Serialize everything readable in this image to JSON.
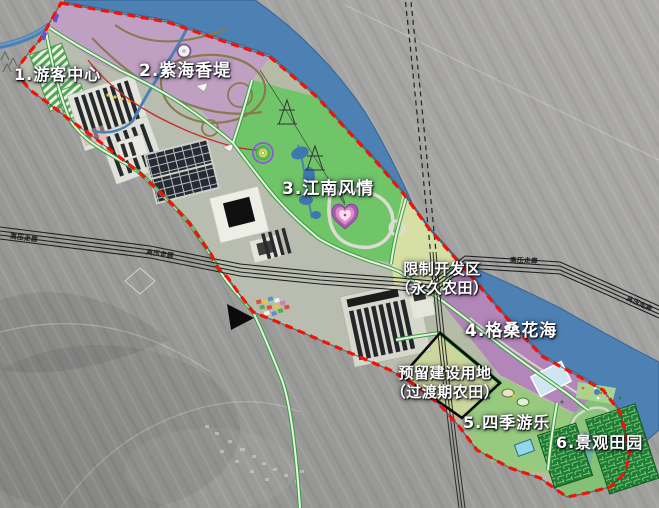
{
  "map": {
    "zones": [
      {
        "label": "1.游客中心"
      },
      {
        "label": "2.紫海香堤"
      },
      {
        "label": "3.江南风情"
      },
      {
        "label": "4.格桑花海"
      },
      {
        "label": "5.四季游乐"
      },
      {
        "label": "6.景观田园"
      }
    ],
    "restricted_area": {
      "line1": "限制开发区",
      "line2": "（永久农田）"
    },
    "reserved_area": {
      "line1": "预留建设用地",
      "line2": "（过渡期农田）"
    },
    "power_corridor_label": "高压走廊",
    "colors": {
      "boundary_red": "#ef1408",
      "river_blue": "#4d81b4",
      "zone1_gray": "#b9bdb0",
      "zone2_purple": "#c0a0c2",
      "zone3_green": "#70c569",
      "zone4_purple": "#b286b8",
      "zone5_green": "#97ca7f",
      "zone6_green": "#83c276",
      "farmland_yellow": "#d6dfa4",
      "reserved_yellow": "#cbd79c",
      "maze_green": "#1f7c34",
      "road_green": "#2fa03a"
    }
  }
}
